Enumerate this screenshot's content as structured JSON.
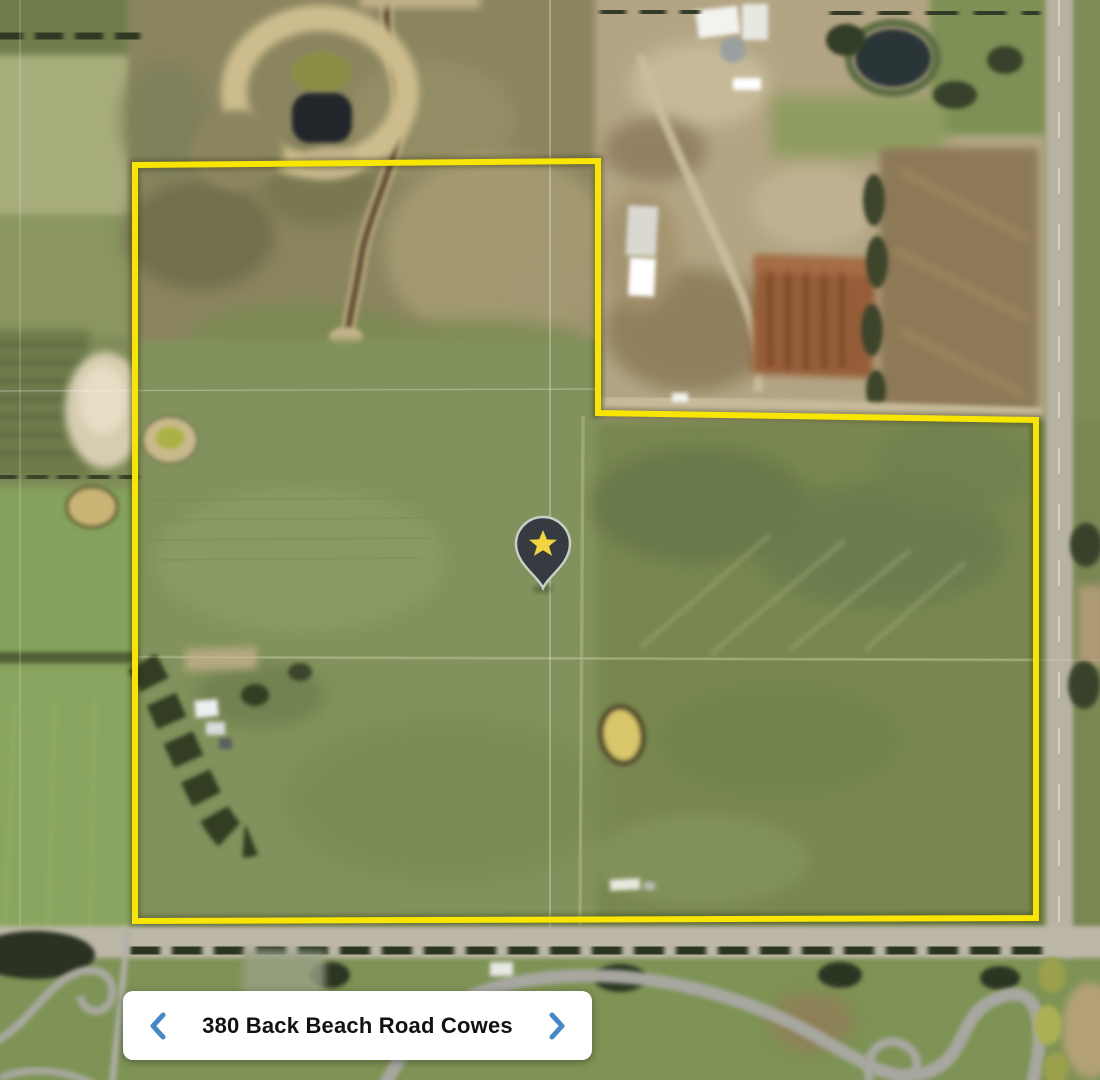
{
  "map": {
    "boundary_color": "#f8e600",
    "marker": {
      "icon": "star-pin-icon",
      "pin_color": "#363b42",
      "pin_outline_color": "#c8cec8",
      "star_color": "#f2d53c"
    }
  },
  "address_card": {
    "label": "380 Back Beach Road Cowes",
    "prev_icon": "chevron-left-icon",
    "next_icon": "chevron-right-icon",
    "chevron_color": "#4488cc"
  }
}
